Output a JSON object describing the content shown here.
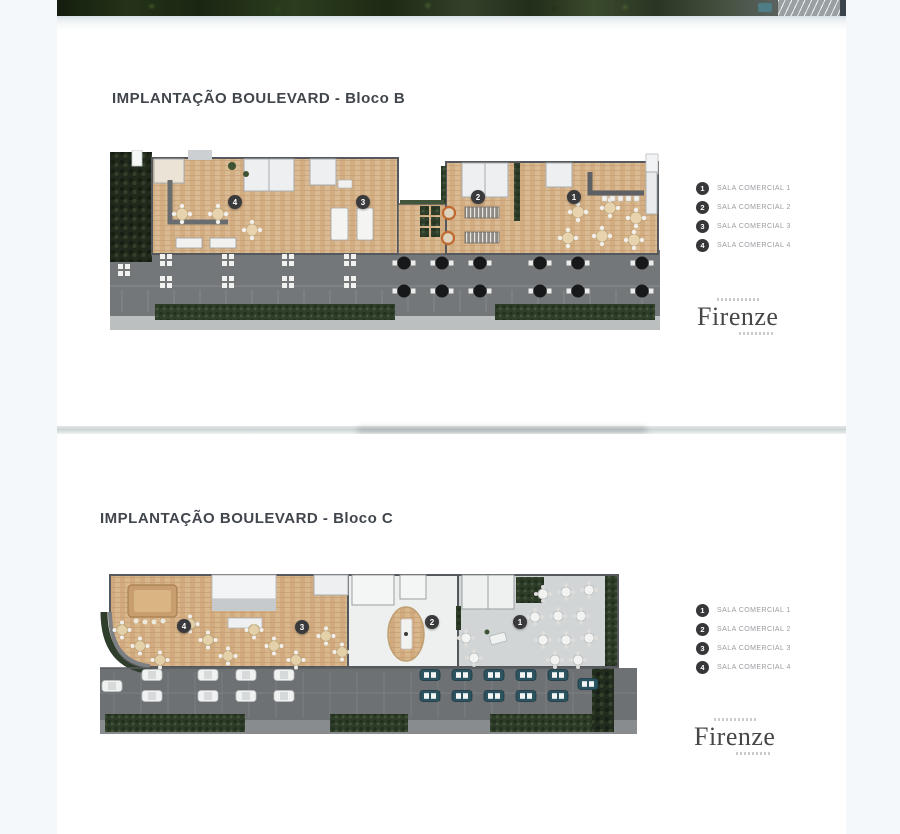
{
  "page": {
    "background": "#f4f8fb",
    "card_color": "#ffffff"
  },
  "colors": {
    "title_text": "#41464d",
    "legend_badge": "#37373a",
    "legend_label": "#999da1",
    "marker_badge": "#3a3a3c",
    "wood_floor": "#daba92",
    "terrace_asphalt": "#747779",
    "hedge_green": "#2f3e2a"
  },
  "sections": [
    {
      "id": "bloco-b",
      "title": "IMPLANTAÇÃO BOULEVARD - Bloco B",
      "legend": [
        {
          "number": "1",
          "label": "SALA COMERCIAL 1"
        },
        {
          "number": "2",
          "label": "SALA COMERCIAL 2"
        },
        {
          "number": "3",
          "label": "SALA COMERCIAL 3"
        },
        {
          "number": "4",
          "label": "SALA COMERCIAL 4"
        }
      ],
      "markers": [
        {
          "number": "4"
        },
        {
          "number": "3"
        },
        {
          "number": "2"
        },
        {
          "number": "1"
        }
      ],
      "logo": {
        "name": "Firenze"
      }
    },
    {
      "id": "bloco-c",
      "title": "IMPLANTAÇÃO BOULEVARD - Bloco C",
      "legend": [
        {
          "number": "1",
          "label": "SALA COMERCIAL 1"
        },
        {
          "number": "2",
          "label": "SALA COMERCIAL 2"
        },
        {
          "number": "3",
          "label": "SALA COMERCIAL 3"
        },
        {
          "number": "4",
          "label": "SALA COMERCIAL 4"
        }
      ],
      "markers": [
        {
          "number": "4"
        },
        {
          "number": "3"
        },
        {
          "number": "2"
        },
        {
          "number": "1"
        }
      ],
      "logo": {
        "name": "Firenze"
      }
    }
  ]
}
